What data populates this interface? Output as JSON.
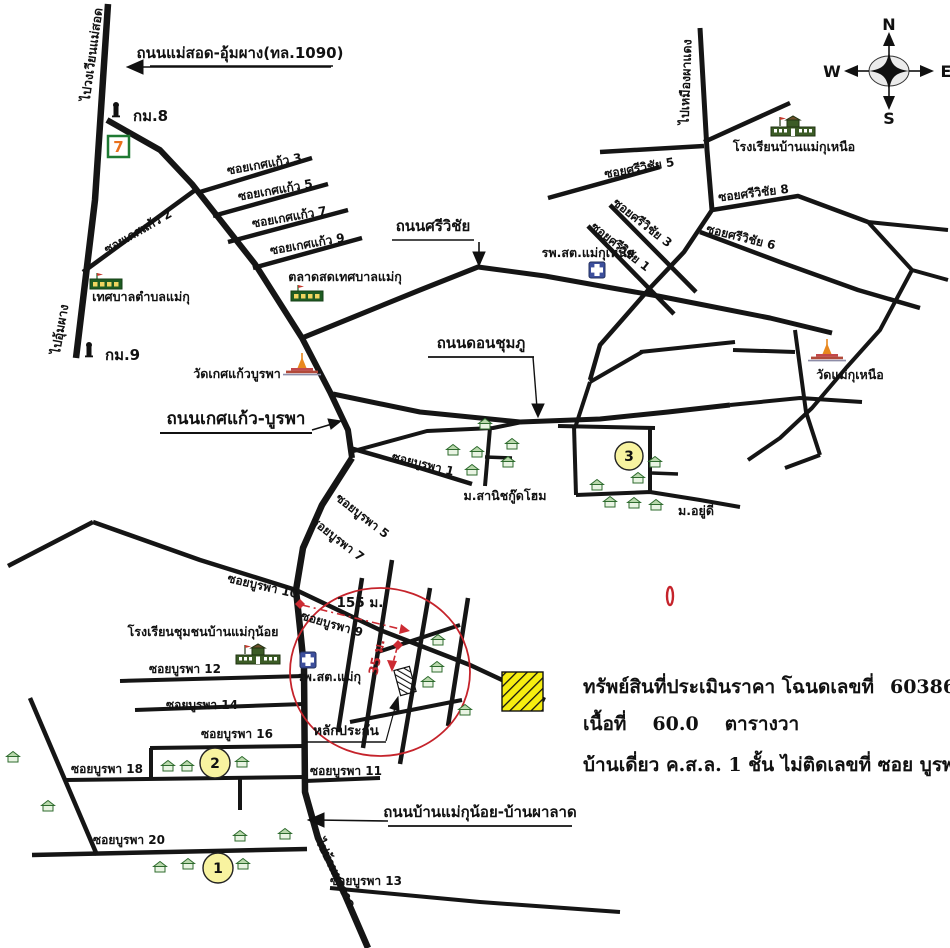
{
  "compass": {
    "north": "N",
    "east": "E",
    "south": "S",
    "west": "W"
  },
  "directions": {
    "to_maesot_roundabout": "ไปวงเวียนแม่สอด",
    "to_umphang": "ไปอุ้มผาง",
    "to_phadaeng_mine": "ไปเหมืองผาแดง",
    "to_ban_phalat": "ไปบ้านผาลาด"
  },
  "road_names": {
    "maesot_umphang": "ถนนแม่สอด-อุ้มผาง(ทล.1090)",
    "sriwichai": "ถนนศรีวิชัย",
    "ketkaew_burapha": "ถนนเกศแก้ว-บูรพา",
    "don_chumphu": "ถนนดอนชุมภู",
    "ban_maekunoi_phalat": "ถนนบ้านแม่กุน้อย-บ้านผาลาด"
  },
  "kilometre_posts": {
    "km8": "กม.8",
    "km9": "กม.9"
  },
  "sois": {
    "ketkaew_2": "ซอยเกศแก้ว 2",
    "ketkaew_3": "ซอยเกศแก้ว 3",
    "ketkaew_5": "ซอยเกศแก้ว 5",
    "ketkaew_7": "ซอยเกศแก้ว 7",
    "ketkaew_9": "ซอยเกศแก้ว 9",
    "sriwichai_1": "ซอยศรีวิชัย 1",
    "sriwichai_3": "ซอยศรีวิชัย 3",
    "sriwichai_5": "ซอยศรีวิชัย 5",
    "sriwichai_6": "ซอยศรีวิชัย 6",
    "sriwichai_8": "ซอยศรีวิชัย 8",
    "burapha_1": "ซอยบูรพา 1",
    "burapha_5": "ซอยบูรพา 5",
    "burapha_7": "ซอยบูรพา 7",
    "burapha_9": "ซอยบูรพา 9",
    "burapha_10": "ซอยบูรพา 10",
    "burapha_11": "ซอยบูรพา 11",
    "burapha_12": "ซอยบูรพา 12",
    "burapha_13": "ซอยบูรพา 13",
    "burapha_14": "ซอยบูรพา 14",
    "burapha_16": "ซอยบูรพา 16",
    "burapha_18": "ซอยบูรพา 18",
    "burapha_20": "ซอยบูรพา 20"
  },
  "places": {
    "tessaban_tambon_maeku": "เทศบาลตำบลแม่กุ",
    "talat_sot_tessaban_maeku": "ตลาดสดเทศบาลแม่กุ",
    "wat_ketkaew_burapha": "วัดเกศแก้วบูรพา",
    "wat_maeku_nuea": "วัดแม่กุเหนือ",
    "health_center_maeku_nuea": "รพ.สต.แม่กุเหนือ",
    "school_ban_maeku_nuea": "โรงเรียนบ้านแม่กุเหนือ",
    "school_chumchon_ban_maekunoi": "โรงเรียนชุมชนบ้านแม่กุน้อย",
    "health_center_maeku": "รพ.สต.แม่กุ",
    "village_sanit_goodhome": "ม.สานิชกู๊ดโฮม",
    "village_yudee": "ม.อยู่ดี"
  },
  "markers": {
    "circle_1": "1",
    "circle_2": "2",
    "circle_3": "3",
    "collateral_label": "หลักประกัน",
    "distance_155": "155 ม.",
    "distance_35": "35 ม.",
    "seven_label": "7"
  },
  "legend": {
    "line1_label": "ทรัพย์สินที่ประเมินราคา โฉนดเลขที่",
    "deed_no": "60386",
    "line2_label": "เนื้อที่",
    "area_value": "60.0",
    "area_unit": "ตารางวา",
    "line3": "บ้านเดี่ยว ค.ส.ล. 1 ชั้น  ไม่ติดเลขที่   ซอย  บูรพา 9"
  },
  "colors": {
    "road": "#151515",
    "highlight_red": "#c5232b",
    "marker_yellow": "#f8f3a0",
    "legend_yellow": "#f6ee10",
    "hospital_blue": "#3d4f9c",
    "house_green": "#2e6b2e",
    "temple_orange": "#e8871e"
  }
}
